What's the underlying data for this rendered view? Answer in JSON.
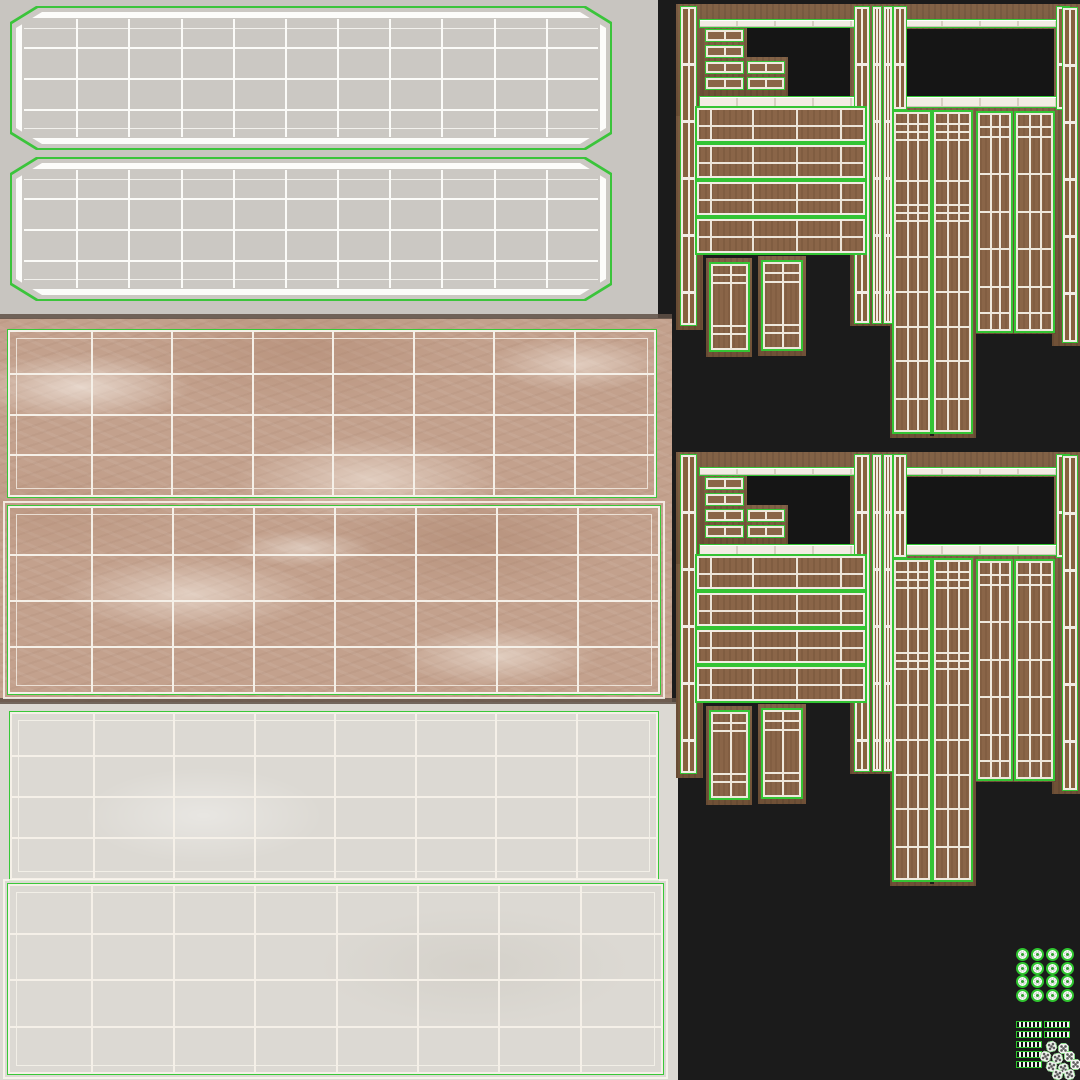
{
  "meta": {
    "canvas_w": 1080,
    "canvas_h": 1080
  },
  "colors": {
    "atlas_bg": "#1b1b1b",
    "gray_bg": "#c8c5c0",
    "gray_panel_fill": "#cbc8c3",
    "white_bg": "#dcd9d3",
    "marble_base": "#c3a18d",
    "marble_vein": "#f2e8dd",
    "wood_backing": "#7c5a3d",
    "wood_face": "#8a6548",
    "wireframe_green": "#34c434",
    "wireframe_white": "#f3ede3",
    "opening_black": "#151515"
  },
  "regions": {
    "gray": {
      "x": 0,
      "y": 0,
      "w": 658,
      "h": 318
    },
    "marble": {
      "x": 0,
      "y": 318,
      "w": 672,
      "h": 384
    },
    "white": {
      "x": 0,
      "y": 702,
      "w": 678,
      "h": 378
    },
    "divider_top": {
      "x": 0,
      "y": 314,
      "w": 672,
      "h": 5
    },
    "divider_bottom": {
      "x": 0,
      "y": 698,
      "w": 678,
      "h": 6
    }
  },
  "gray_panels": [
    {
      "x": 10,
      "y": 6,
      "w": 602,
      "h": 144
    },
    {
      "x": 10,
      "y": 157,
      "w": 602,
      "h": 144
    }
  ],
  "gray_grid": {
    "cols": 11,
    "row_fracs": [
      0.08,
      0.24,
      0.5,
      0.76,
      0.92
    ]
  },
  "flat_panels": [
    {
      "x": 8,
      "y": 330,
      "w": 648,
      "h": 167,
      "cols": 8,
      "rows": 4,
      "outer": false
    },
    {
      "x": 8,
      "y": 506,
      "w": 652,
      "h": 188,
      "cols": 8,
      "rows": 4,
      "outer": true
    },
    {
      "x": 10,
      "y": 712,
      "w": 648,
      "h": 168,
      "cols": 8,
      "rows": 4,
      "outer": false
    },
    {
      "x": 8,
      "y": 884,
      "w": 655,
      "h": 190,
      "cols": 8,
      "rows": 4,
      "outer": true
    }
  ],
  "wood": {
    "set_offsets": [
      0,
      448
    ],
    "backings": [
      {
        "x": 676,
        "y": 4,
        "w": 27,
        "h": 326
      },
      {
        "x": 676,
        "y": 4,
        "w": 202,
        "h": 112
      },
      {
        "x": 850,
        "y": 4,
        "w": 45,
        "h": 322
      },
      {
        "x": 892,
        "y": 4,
        "w": 188,
        "h": 108
      },
      {
        "x": 1052,
        "y": 4,
        "w": 28,
        "h": 342
      },
      {
        "x": 890,
        "y": 108,
        "w": 86,
        "h": 330
      },
      {
        "x": 976,
        "y": 108,
        "w": 82,
        "h": 226
      },
      {
        "x": 706,
        "y": 258,
        "w": 46,
        "h": 99
      },
      {
        "x": 758,
        "y": 256,
        "w": 48,
        "h": 100
      }
    ],
    "openings": [
      {
        "x": 703,
        "y": 27,
        "w": 147,
        "h": 69
      },
      {
        "x": 906,
        "y": 29,
        "w": 148,
        "h": 67
      }
    ],
    "drawer_backings": [
      {
        "x": 702,
        "y": 25,
        "w": 45,
        "h": 71
      },
      {
        "x": 744,
        "y": 57,
        "w": 44,
        "h": 39
      }
    ],
    "drawers": [
      {
        "x": 706,
        "y": 30,
        "w": 37,
        "h": 11
      },
      {
        "x": 706,
        "y": 46,
        "w": 37,
        "h": 11
      },
      {
        "x": 706,
        "y": 62,
        "w": 37,
        "h": 11
      },
      {
        "x": 706,
        "y": 78,
        "w": 37,
        "h": 11
      },
      {
        "x": 748,
        "y": 62,
        "w": 36,
        "h": 11
      },
      {
        "x": 748,
        "y": 78,
        "w": 36,
        "h": 11
      }
    ],
    "rails": [
      {
        "x": 699,
        "y": 19,
        "w": 157,
        "h": 9
      },
      {
        "x": 699,
        "y": 96,
        "w": 157,
        "h": 12
      },
      {
        "x": 904,
        "y": 19,
        "w": 153,
        "h": 9
      },
      {
        "x": 904,
        "y": 96,
        "w": 153,
        "h": 12
      }
    ],
    "posts": [
      {
        "x": 681,
        "y": 7,
        "w": 15,
        "h": 318
      },
      {
        "x": 855,
        "y": 7,
        "w": 14,
        "h": 316
      },
      {
        "x": 873,
        "y": 7,
        "w": 8,
        "h": 316
      },
      {
        "x": 884,
        "y": 7,
        "w": 8,
        "h": 316
      },
      {
        "x": 894,
        "y": 7,
        "w": 12,
        "h": 102
      },
      {
        "x": 1057,
        "y": 7,
        "w": 12,
        "h": 102
      },
      {
        "x": 1063,
        "y": 8,
        "w": 14,
        "h": 334
      }
    ],
    "planks": [
      {
        "x": 697,
        "y": 108,
        "w": 168,
        "h": 33
      },
      {
        "x": 697,
        "y": 145,
        "w": 168,
        "h": 33
      },
      {
        "x": 697,
        "y": 182,
        "w": 168,
        "h": 33
      },
      {
        "x": 697,
        "y": 219,
        "w": 168,
        "h": 34
      }
    ],
    "small_panels": [
      {
        "x": 711,
        "y": 264,
        "w": 37,
        "h": 86
      },
      {
        "x": 763,
        "y": 262,
        "w": 38,
        "h": 87
      }
    ],
    "small_panel_rungs": [
      0.1,
      0.2,
      0.72,
      0.82
    ],
    "small_panel_vls": [
      0.5
    ],
    "door_gap": {
      "x": 930,
      "y": 110,
      "w": 4,
      "h": 326
    },
    "door_panels": [
      {
        "x": 894,
        "y": 112,
        "w": 36,
        "h": 320,
        "rungs": [
          0.03,
          0.055,
          0.08,
          0.21,
          0.285,
          0.31,
          0.335,
          0.45,
          0.56,
          0.67,
          0.78,
          0.9
        ],
        "vls": [
          0.33,
          0.66
        ]
      },
      {
        "x": 934,
        "y": 112,
        "w": 37,
        "h": 320,
        "rungs": [
          0.03,
          0.055,
          0.08,
          0.21,
          0.285,
          0.31,
          0.335,
          0.45,
          0.56,
          0.67,
          0.78,
          0.9
        ],
        "vls": [
          0.33,
          0.66
        ]
      },
      {
        "x": 978,
        "y": 113,
        "w": 33,
        "h": 218,
        "rungs": [
          0.05,
          0.1,
          0.27,
          0.45,
          0.62,
          0.8,
          0.92
        ],
        "vls": [
          0.33,
          0.66
        ]
      },
      {
        "x": 1016,
        "y": 113,
        "w": 37,
        "h": 218,
        "rungs": [
          0.05,
          0.1,
          0.27,
          0.45,
          0.62,
          0.8,
          0.92
        ],
        "vls": [
          0.33,
          0.66
        ]
      }
    ]
  },
  "icons": {
    "discs": {
      "x": 1016,
      "y": 948,
      "cols": 4,
      "rows": 4,
      "step_x": 15,
      "step_y": 13.6,
      "d": 13
    },
    "bars": {
      "x": 1016,
      "y": 1021,
      "h": 7,
      "step_y": 10,
      "left_w": 26,
      "right_dx": 28,
      "right_w": 26,
      "rows": [
        2,
        2,
        1,
        1,
        1
      ]
    },
    "dice": {
      "d": 11,
      "pos": [
        [
          1046,
          1041
        ],
        [
          1058,
          1043
        ],
        [
          1040,
          1051
        ],
        [
          1052,
          1053
        ],
        [
          1064,
          1051
        ],
        [
          1046,
          1061
        ],
        [
          1058,
          1063
        ],
        [
          1070,
          1059
        ],
        [
          1052,
          1069
        ],
        [
          1064,
          1069
        ]
      ]
    }
  }
}
